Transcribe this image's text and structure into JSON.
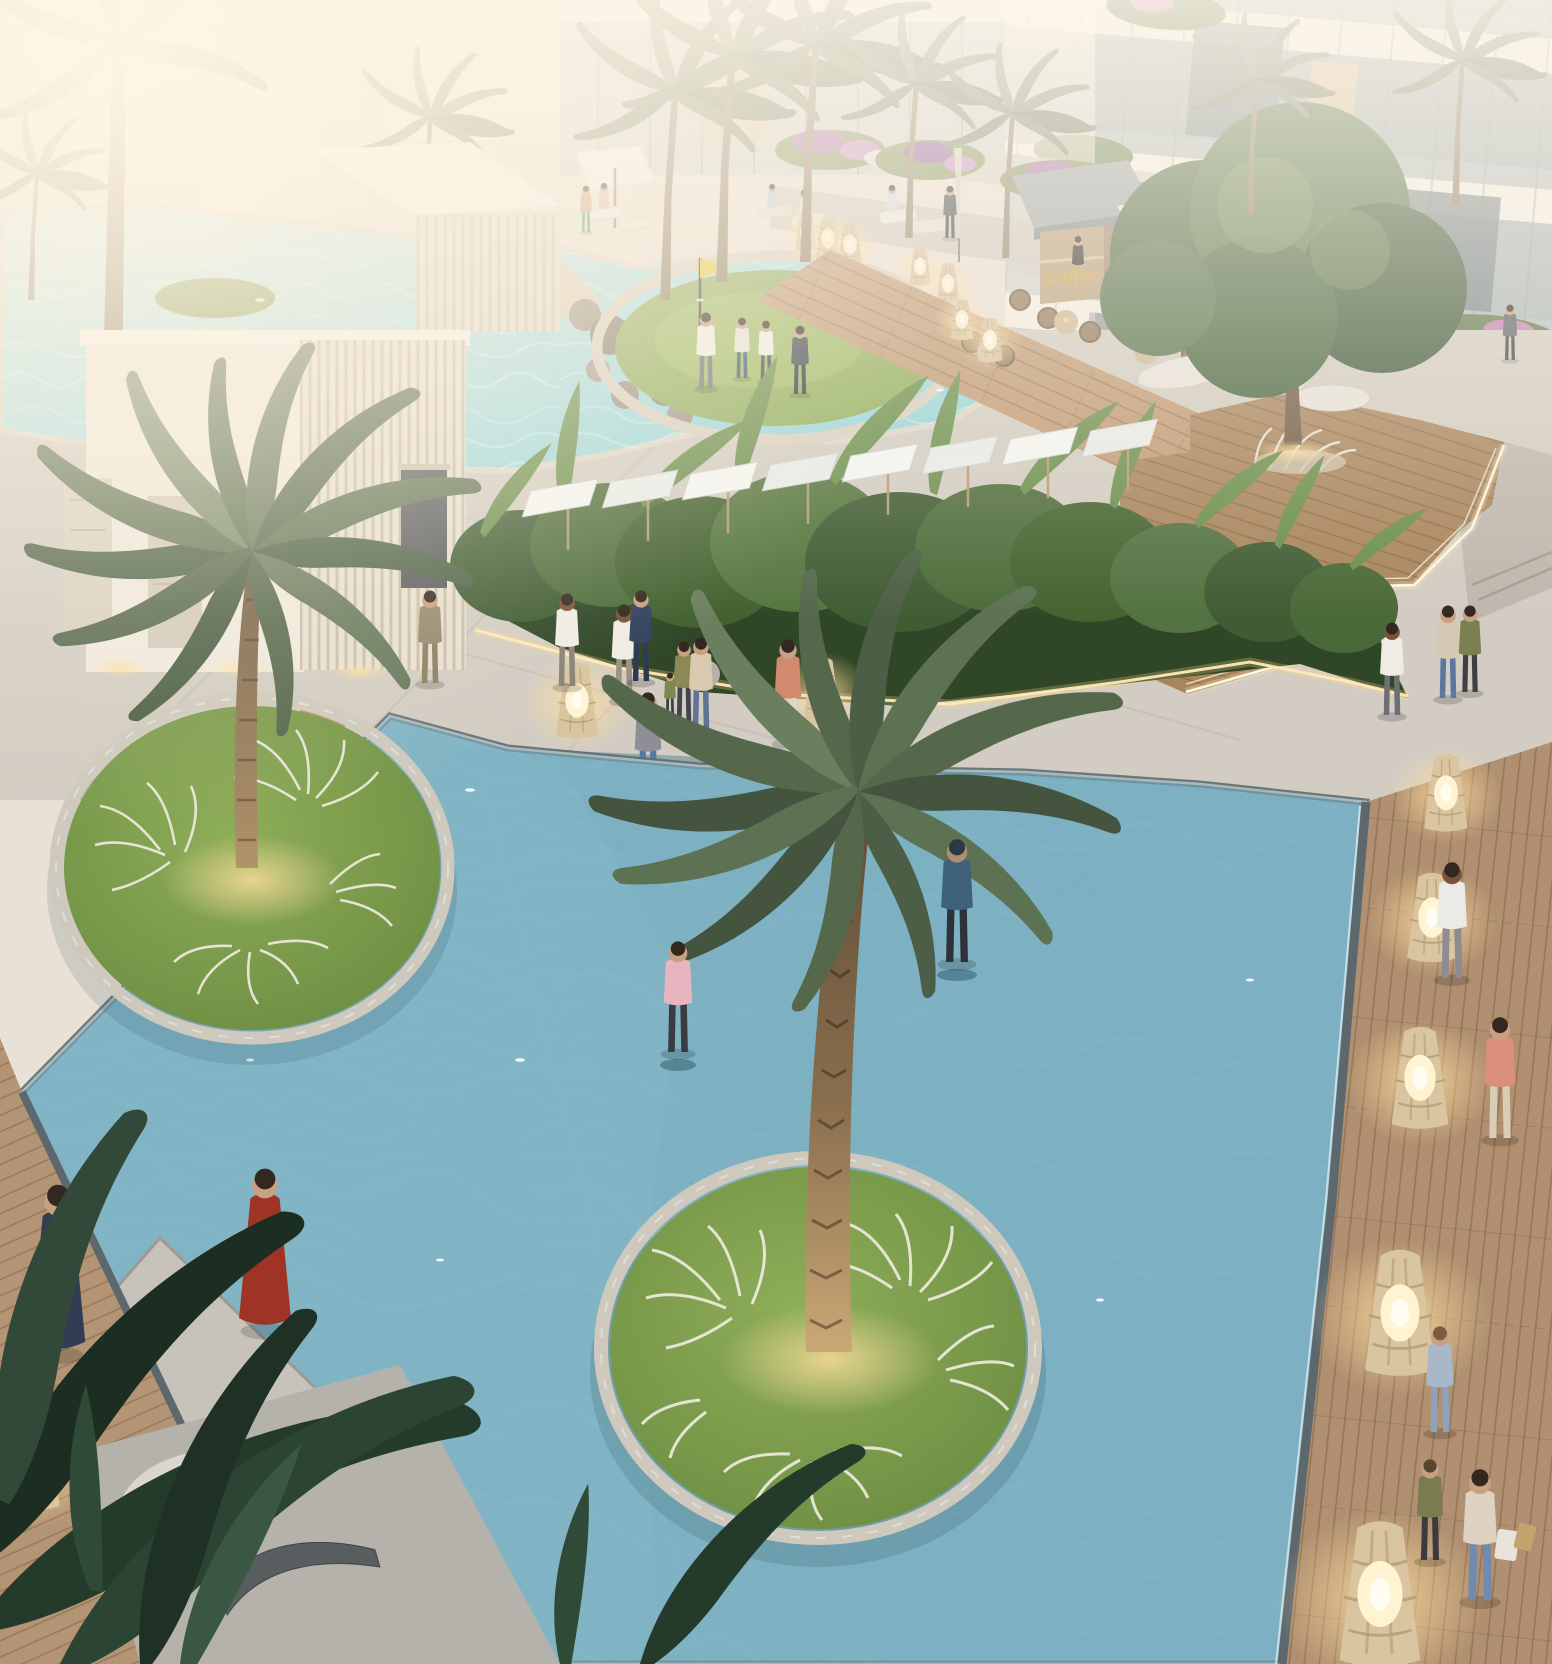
{
  "scene": {
    "type": "architectural-render",
    "title": "Resort pool courtyard at dusk, aerial view",
    "signage": {
      "kiosk_sign": "Coffee"
    },
    "palette": {
      "haze_warm": "#f5ecdc",
      "concrete": "#d2ccc2",
      "deck_wood": "#b09070",
      "walkway_wood": "#c09a74",
      "pool_pale": "#b4d9dd",
      "pool_deep": "#548ea8",
      "upper_pool": "#9fd9dd",
      "island_grass": "#7d9c4f",
      "palm_green": "#5d7252",
      "hedge_green": "#4a6b3a",
      "lantern_glow": "#ffd9a0",
      "led_strip": "#ffeebb",
      "golf_flag": "#e9c93c",
      "flowers_purple": "#b06fb5",
      "sign_gold": "#d9a833"
    },
    "objects": [
      "residential tower with glass balconies and planted terraces",
      "white slatted pool pavilions",
      "upper lagoon pool with rock cascade",
      "circular putting green with yellow golf flag and four players",
      "coffee kiosk with gold Coffee sign and pendant lights",
      "cafe terrace with wicker chairs, tables and white umbrellas",
      "shade-sail pergola over loungers",
      "tropical hedge planter with LED underglow",
      "raised timber event deck with LED edge lighting",
      "large shallow reflecting pool with submerged walkways",
      "two circular grass islands with date palms and white ornamental grasses",
      "glowing wicker lantern bollards",
      "timber boardwalk with pedestrians and shoppers",
      "curved designer sun loungers",
      "woman in red dress on stone pool platform",
      "man in hooded sweatshirt walking through shallow water"
    ],
    "counts": {
      "palm_islands": 2,
      "lanterns_visible": 12,
      "approx_people": 34
    }
  }
}
